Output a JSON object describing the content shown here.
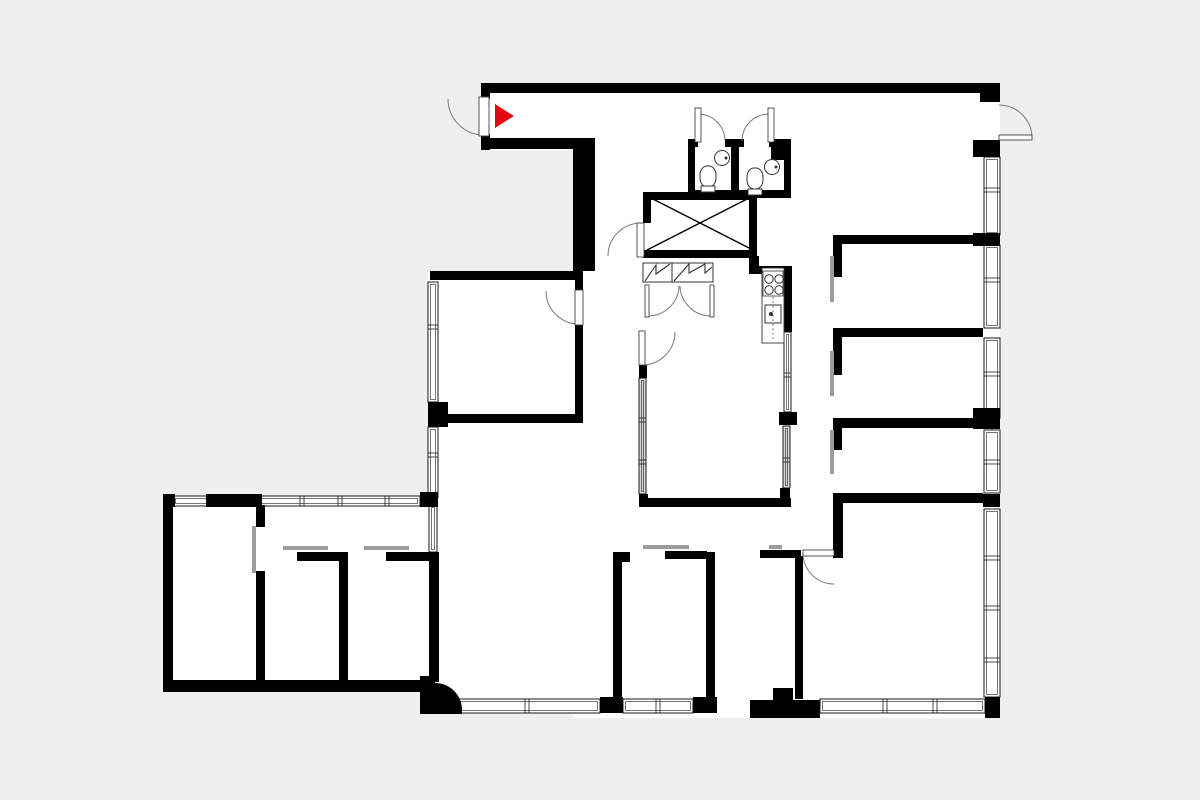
{
  "meta": {
    "title": "apartment-floor-plan",
    "canvas": {
      "width": 1200,
      "height": 800
    },
    "colors": {
      "background": "#efefef",
      "floor": "#ffffff",
      "wall": "#000000",
      "window_stroke": "#1a1a1a",
      "glass_fill": "#d8d8d8",
      "slider": "#9c9c9c",
      "arc": "#7a7a7a",
      "leaf_stroke": "#444444",
      "fixture_stroke": "#333333",
      "marker_red": "#e30613"
    }
  },
  "floorplan": {
    "floors": [
      [
        482,
        83,
        518,
        67
      ],
      [
        573,
        93,
        427,
        625
      ],
      [
        428,
        272,
        155,
        225
      ],
      [
        163,
        497,
        275,
        195
      ],
      [
        420,
        497,
        160,
        216
      ]
    ],
    "walls": [
      [
        482,
        83,
        518,
        10
      ],
      [
        980,
        83,
        20,
        19
      ],
      [
        481,
        83,
        9,
        16
      ],
      [
        481,
        134,
        9,
        16
      ],
      [
        481,
        138,
        114,
        11
      ],
      [
        573,
        149,
        22,
        122
      ],
      [
        430,
        271,
        153,
        9
      ],
      [
        575,
        278,
        8,
        14
      ],
      [
        575,
        324,
        8,
        96
      ],
      [
        446,
        414,
        137,
        9
      ],
      [
        428,
        402,
        20,
        25
      ],
      [
        163,
        494,
        12,
        13
      ],
      [
        206,
        494,
        56,
        13
      ],
      [
        420,
        492,
        18,
        15
      ],
      [
        163,
        497,
        10,
        195
      ],
      [
        163,
        680,
        272,
        12
      ],
      [
        256,
        505,
        9,
        22
      ],
      [
        256,
        571,
        9,
        121
      ],
      [
        297,
        552,
        46,
        9
      ],
      [
        339,
        552,
        9,
        130
      ],
      [
        386,
        552,
        48,
        9
      ],
      [
        429,
        552,
        10,
        130
      ],
      [
        643,
        192,
        114,
        8
      ],
      [
        688,
        190,
        103,
        8
      ],
      [
        643,
        192,
        8,
        31
      ],
      [
        749,
        192,
        8,
        66
      ],
      [
        643,
        250,
        114,
        8
      ],
      [
        749,
        256,
        10,
        18
      ],
      [
        749,
        266,
        43,
        8
      ],
      [
        784,
        268,
        8,
        64
      ],
      [
        779,
        412,
        18,
        13
      ],
      [
        780,
        488,
        10,
        12
      ],
      [
        639,
        365,
        8,
        13
      ],
      [
        639,
        494,
        9,
        13
      ],
      [
        640,
        498,
        151,
        9
      ],
      [
        688,
        139,
        10,
        8
      ],
      [
        725,
        139,
        19,
        8
      ],
      [
        769,
        139,
        22,
        8
      ],
      [
        771,
        139,
        19,
        21
      ],
      [
        688,
        139,
        7,
        59
      ],
      [
        731,
        140,
        8,
        56
      ],
      [
        784,
        139,
        7,
        59
      ],
      [
        833,
        235,
        150,
        9
      ],
      [
        973,
        233,
        27,
        13
      ],
      [
        833,
        244,
        9,
        33
      ],
      [
        833,
        328,
        150,
        9
      ],
      [
        833,
        337,
        9,
        38
      ],
      [
        833,
        418,
        150,
        10
      ],
      [
        973,
        408,
        27,
        21
      ],
      [
        833,
        427,
        9,
        23
      ],
      [
        833,
        493,
        150,
        10
      ],
      [
        983,
        494,
        17,
        13
      ],
      [
        833,
        493,
        10,
        65
      ],
      [
        760,
        550,
        41,
        8
      ],
      [
        795,
        556,
        8,
        143
      ],
      [
        613,
        552,
        17,
        10
      ],
      [
        613,
        552,
        9,
        150
      ],
      [
        665,
        551,
        42,
        8
      ],
      [
        706,
        552,
        9,
        150
      ],
      [
        600,
        697,
        23,
        16
      ],
      [
        693,
        697,
        24,
        16
      ],
      [
        750,
        700,
        70,
        18
      ],
      [
        773,
        688,
        20,
        14
      ],
      [
        985,
        697,
        15,
        21
      ],
      [
        973,
        140,
        27,
        17
      ]
    ],
    "curved_corner_path": "M420,676 L435,676 L435,683 A27 27 0 0 1 462,710 L462,714 L420,714 Z",
    "windows": [
      {
        "r": [
          428,
          282,
          10,
          120
        ],
        "o": "v",
        "m": [
          327
        ]
      },
      {
        "r": [
          428,
          427,
          10,
          70
        ],
        "o": "v",
        "m": [
          455
        ]
      },
      {
        "r": [
          429,
          505,
          8,
          47
        ],
        "o": "v",
        "m": []
      },
      {
        "r": [
          173,
          496,
          247,
          10
        ],
        "o": "h",
        "m": [
          302,
          340,
          387
        ]
      },
      {
        "r": [
          187,
          681,
          63,
          10
        ],
        "o": "h",
        "m": [
          218
        ]
      },
      {
        "r": [
          270,
          681,
          63,
          10
        ],
        "o": "h",
        "m": [
          301
        ]
      },
      {
        "r": [
          350,
          681,
          63,
          10
        ],
        "o": "h",
        "m": [
          381
        ]
      },
      {
        "r": [
          984,
          157,
          16,
          78
        ],
        "o": "v",
        "m": [
          190
        ]
      },
      {
        "r": [
          984,
          245,
          16,
          83
        ],
        "o": "v",
        "m": [
          280
        ]
      },
      {
        "r": [
          984,
          338,
          16,
          80
        ],
        "o": "v",
        "m": [
          374
        ]
      },
      {
        "r": [
          984,
          430,
          16,
          63
        ],
        "o": "v",
        "m": [
          462
        ]
      },
      {
        "r": [
          984,
          509,
          16,
          188
        ],
        "o": "v",
        "m": [
          558,
          608,
          660
        ]
      },
      {
        "r": [
          784,
          332,
          7,
          80
        ],
        "o": "v",
        "m": [
          375
        ]
      },
      {
        "r": [
          455,
          699,
          145,
          14
        ],
        "o": "h",
        "m": [
          527
        ]
      },
      {
        "r": [
          623,
          699,
          70,
          14
        ],
        "o": "h",
        "m": [
          658
        ]
      },
      {
        "r": [
          820,
          699,
          165,
          14
        ],
        "o": "h",
        "m": [
          885,
          935
        ]
      }
    ],
    "glass_panels": [
      {
        "r": [
          639,
          378,
          7,
          116
        ],
        "o": "v",
        "m": [
          420,
          462
        ]
      },
      {
        "r": [
          783,
          426,
          7,
          62
        ],
        "o": "v",
        "m": [
          460
        ]
      }
    ],
    "sliding_doors": [
      [
        252,
        526,
        4,
        47
      ],
      [
        283,
        546,
        45,
        4
      ],
      [
        364,
        546,
        45,
        4
      ],
      [
        643,
        545,
        46,
        4
      ],
      [
        769,
        545,
        13,
        4
      ],
      [
        830,
        256,
        4,
        46
      ],
      [
        830,
        351,
        4,
        45
      ],
      [
        830,
        430,
        4,
        44
      ]
    ],
    "doors": [
      {
        "name": "entrance-door",
        "leaf": [
          479,
          97,
          10,
          39
        ],
        "arc": "M448,99 A36 36 0 0 0 484,135"
      },
      {
        "name": "terrace-door",
        "leaf": [
          999,
          135,
          33,
          5
        ],
        "arc": "M1032,138 A33 33 0 0 0 999,105"
      },
      {
        "name": "wc-left-door",
        "leaf": [
          695,
          108,
          6,
          34
        ],
        "arc": "M698,114 A27 27 0 0 1 725,141"
      },
      {
        "name": "wc-right-door",
        "leaf": [
          768,
          108,
          6,
          34
        ],
        "arc": "M769,114 A27 27 0 0 0 742,141"
      },
      {
        "name": "stairwell-door",
        "leaf": [
          637,
          223,
          7,
          34
        ],
        "arc": "M641,223 A33 33 0 0 0 608,256"
      },
      {
        "name": "left-room-door",
        "leaf": [
          575,
          290,
          8,
          35
        ],
        "arc": "M546,291 A33 33 0 0 0 579,324"
      },
      {
        "name": "living-room-door",
        "leaf": [
          639,
          331,
          6,
          34
        ],
        "arc": "M642,365 A33 33 0 0 0 675,332"
      },
      {
        "name": "bottom-right-room-door",
        "leaf": [
          803,
          550,
          31,
          6
        ],
        "arc": "M803,553 A31 31 0 0 0 834,584"
      },
      {
        "name": "wardrobe-door-left",
        "leaf": [
          645,
          285,
          4,
          32
        ],
        "arc": "M648,316 A31 31 0 0 0 679,286"
      },
      {
        "name": "wardrobe-door-right",
        "leaf": [
          710,
          285,
          4,
          32
        ],
        "arc": "M711,316 A31 31 0 0 1 680,286"
      }
    ],
    "stairwell": {
      "cross_lines": [
        [
          647,
          196,
          753,
          250
        ],
        [
          647,
          250,
          753,
          196
        ]
      ]
    },
    "stairs": {
      "boxes": [
        [
          643,
          263,
          29,
          19
        ],
        [
          672,
          263,
          41,
          19
        ]
      ],
      "teeth": [
        "M645,281 L656,265 L656,274 L670,264",
        "M674,281 L689,264 L689,273 L705,264 L705,273 L712,267"
      ]
    },
    "kitchen": {
      "counter": [
        762,
        268,
        22,
        75
      ],
      "stove_frame": [
        763,
        271,
        20,
        25
      ],
      "burner_r": 4.2,
      "burners": [
        [
          769,
          279
        ],
        [
          779,
          279
        ],
        [
          769,
          290
        ],
        [
          779,
          290
        ]
      ],
      "sink": [
        765,
        305,
        16,
        18
      ],
      "sink_dot": [
        771,
        314
      ],
      "dash_line": [
        773,
        297,
        773,
        341
      ]
    },
    "toilets": [
      {
        "bowl": [
          700,
          166,
          16,
          21
        ],
        "base": [
          701,
          186,
          14,
          6
        ]
      },
      {
        "bowl": [
          747,
          168,
          16,
          21
        ],
        "base": [
          748,
          189,
          14,
          6
        ]
      }
    ],
    "basins": [
      {
        "c": [
          722,
          158
        ],
        "r": 7.5,
        "dot": [
          726,
          158
        ]
      },
      {
        "c": [
          772,
          167
        ],
        "r": 7.5,
        "dot": [
          776,
          167
        ]
      }
    ],
    "entrance_marker": {
      "icon": "entrance-arrow-icon",
      "points": "495,104 495,128 514,116"
    }
  }
}
